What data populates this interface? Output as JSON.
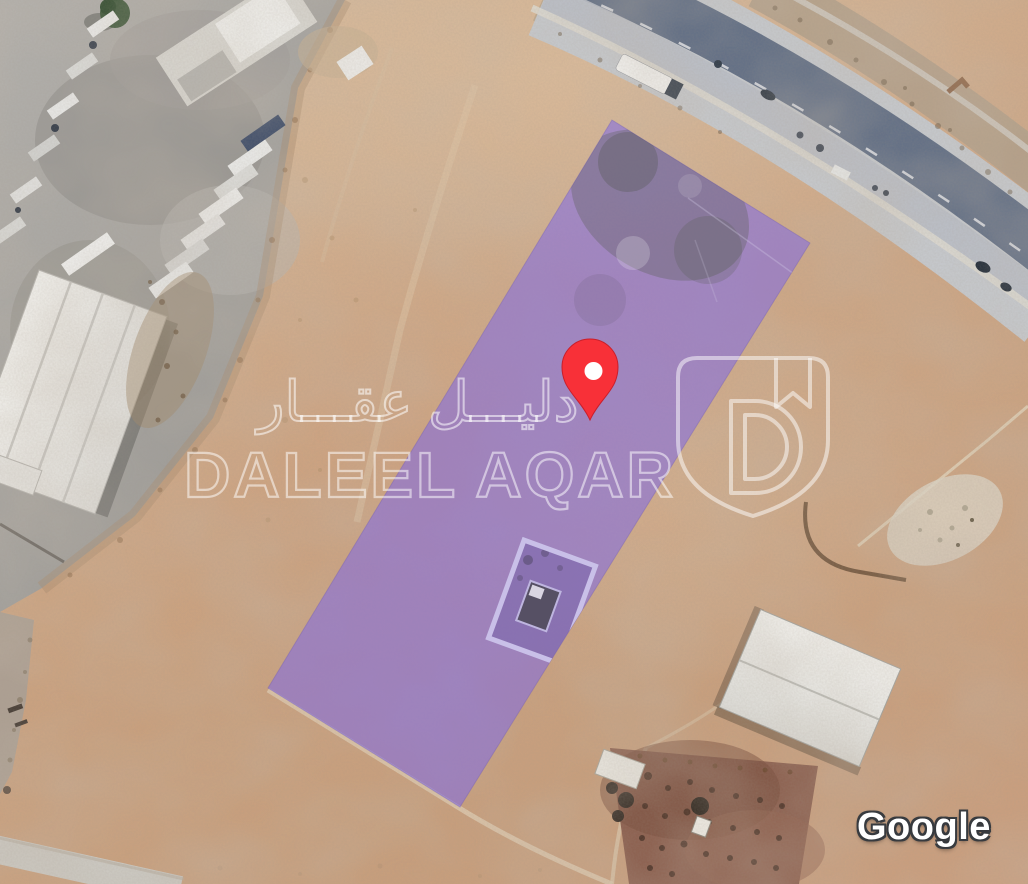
{
  "map": {
    "attribution_label": "Google",
    "view": "satellite"
  },
  "parcel": {
    "color": "#7D67E8",
    "opacity": "0.55"
  },
  "marker": {
    "color": "#F83038",
    "inner_dot_color": "#FFFFFF"
  },
  "watermark": {
    "arabic_text": "دليـــل عقـــار",
    "latin_text": "DALEEL AQAR",
    "logo": "daleel-aqar-shield"
  }
}
